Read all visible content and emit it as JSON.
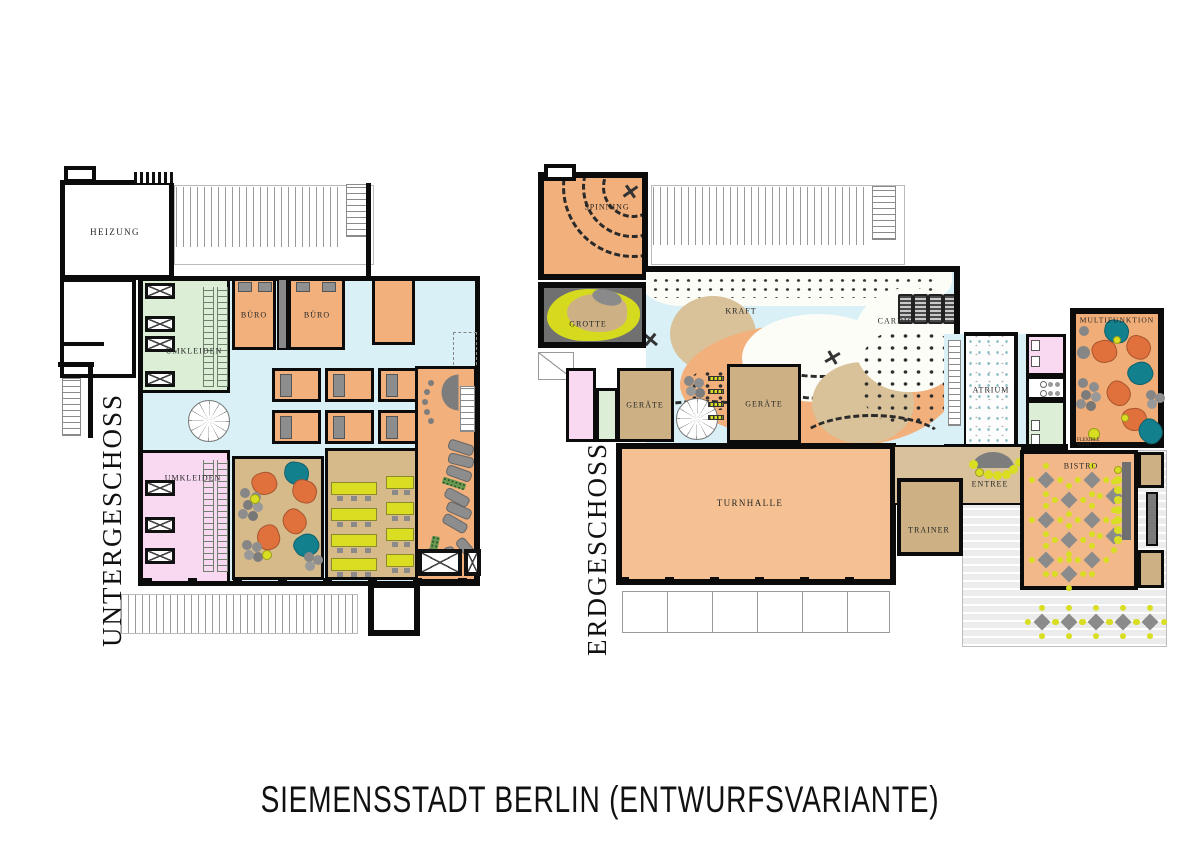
{
  "title": "SIEMENSSTADT BERLIN (ENTWURFSVARIANTE)",
  "floors": {
    "ug": {
      "name": "UNTERGESCHOSS",
      "rooms": {
        "heizung": "HEIZUNG",
        "buero_1": "BÜRO",
        "buero_2": "BÜRO",
        "umkleiden_1": "UMKLEIDEN",
        "umkleiden_2": "UMKLEIDEN"
      }
    },
    "eg": {
      "name": "ERDGESCHOSS",
      "rooms": {
        "spinning": "SPINNING",
        "grotte": "GROTTE",
        "kraft": "KRAFT",
        "cardio": "CARDIO",
        "atrium": "ATRIUM",
        "multifunktion": "MULTIFUNKTION",
        "flexible_wand": "FLEXIBLE WAND",
        "geraete_1": "GERÄTE",
        "geraete_2": "GERÄTE",
        "turnhalle": "TURNHALLE",
        "trainer": "TRAINER",
        "entree": "ENTREE",
        "bistro": "BISTRO"
      }
    }
  },
  "colors": {
    "wall": "#0b0b0b",
    "floor_blue": "#d9f1f6",
    "room_orange": "#f1b07c",
    "room_tan": "#cdb184",
    "room_green": "#ddeed6",
    "room_pink": "#f8d9f1",
    "grotte_yellow": "#d6da1f",
    "furniture_yellow": "#d9de22",
    "pillow_orange": "#e0703c",
    "pillow_teal": "#13808e",
    "furniture_gray": "#8d8d8d"
  }
}
